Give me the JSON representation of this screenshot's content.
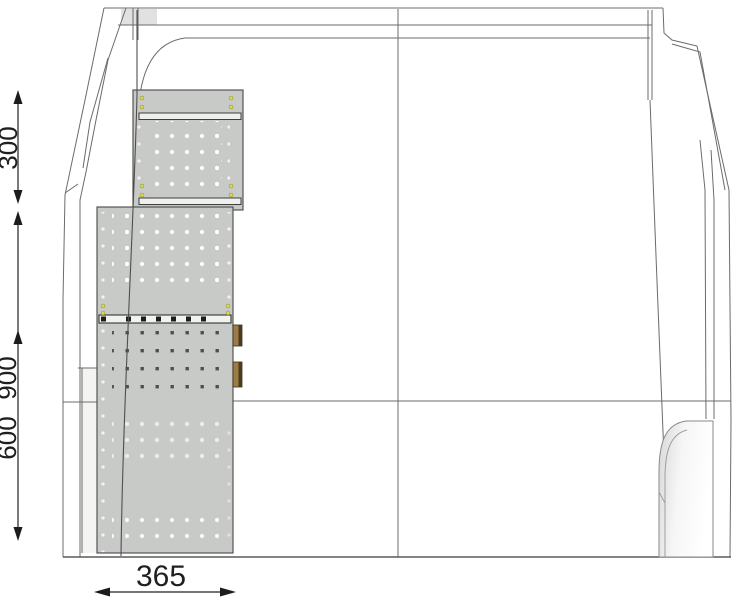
{
  "diagram": {
    "dimensions": {
      "top_unit_height_mm": "300",
      "rack_total_height_mm": "900",
      "rack_lower_height_mm": "600",
      "rack_width_mm": "365"
    },
    "colors": {
      "background": "#ffffff",
      "panel_gray": "#c8cac8",
      "body_outline": "#6b6b6b",
      "rack_outline": "#474747",
      "bracket_brown": "#9c7c44",
      "screw_yellow": "#d9d94f",
      "dimension_ink": "#1f1f1f"
    }
  }
}
